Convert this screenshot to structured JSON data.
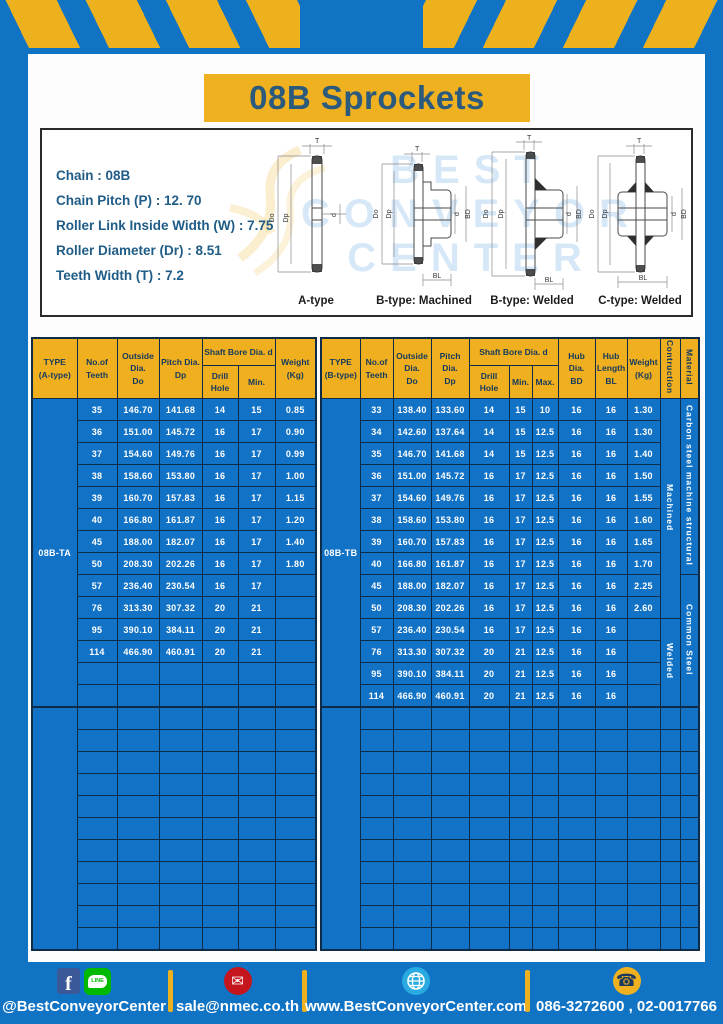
{
  "title": "08B Sprockets",
  "specs": [
    "Chain  : 08B",
    "Chain Pitch (P)  :  12. 70",
    "Roller Link Inside Width (W)  :  7.75",
    "Roller Diameter (Dr)  : 8.51",
    "Teeth Width (T)  :  7.2"
  ],
  "diagrams": {
    "watermark": "BEST CONVEYOR CENTER",
    "captions": [
      "A-type",
      "B-type: Machined",
      "B-type: Welded",
      "C-type: Welded"
    ],
    "dims": {
      "t": "T",
      "outside": "Do",
      "pitch": "Dp",
      "bore": "d",
      "hub_dia": "BD",
      "hub_len": "BL"
    }
  },
  "left_table": {
    "header": {
      "type": "TYPE\n(A-type)",
      "teeth": "No.of\nTeeth",
      "outside": "Outside\nDia.\nDo",
      "pitch": "Pitch Dia.\nDp",
      "shaft_bore": "Shaft Bore Dia. d",
      "drill": "Drill Hole",
      "min": "Min.",
      "weight": "Weight\n(Kg)"
    },
    "type_label": "08B-TA",
    "rows": [
      [
        "35",
        "146.70",
        "141.68",
        "14",
        "15",
        "0.85"
      ],
      [
        "36",
        "151.00",
        "145.72",
        "16",
        "17",
        "0.90"
      ],
      [
        "37",
        "154.60",
        "149.76",
        "16",
        "17",
        "0.99"
      ],
      [
        "38",
        "158.60",
        "153.80",
        "16",
        "17",
        "1.00"
      ],
      [
        "39",
        "160.70",
        "157.83",
        "16",
        "17",
        "1.15"
      ],
      [
        "40",
        "166.80",
        "161.87",
        "16",
        "17",
        "1.20"
      ],
      [
        "45",
        "188.00",
        "182.07",
        "16",
        "17",
        "1.40"
      ],
      [
        "50",
        "208.30",
        "202.26",
        "16",
        "17",
        "1.80"
      ],
      [
        "57",
        "236.40",
        "230.54",
        "16",
        "17",
        ""
      ],
      [
        "76",
        "313.30",
        "307.32",
        "20",
        "21",
        ""
      ],
      [
        "95",
        "390.10",
        "384.11",
        "20",
        "21",
        ""
      ],
      [
        "114",
        "466.90",
        "460.91",
        "20",
        "21",
        ""
      ]
    ],
    "group1_total_rows": 14,
    "group2_empty_rows": 11
  },
  "right_table": {
    "header": {
      "type": "TYPE\n(B-type)",
      "teeth": "No.of\nTeeth",
      "outside": "Outside\nDia.\nDo",
      "pitch": "Pitch Dia.\nDp",
      "shaft_bore": "Shaft Bore Dia. d",
      "drill": "Drill Hole",
      "min": "Min.",
      "max": "Max.",
      "hub_dia": "Hub Dia.\nBD",
      "hub_len": "Hub\nLength\nBL",
      "weight": "Weight\n(Kg)",
      "construction": "Contruction",
      "material": "Material"
    },
    "type_label": "08B-TB",
    "rows": [
      [
        "33",
        "138.40",
        "133.60",
        "14",
        "15",
        "10",
        "16",
        "16",
        "1.30"
      ],
      [
        "34",
        "142.60",
        "137.64",
        "14",
        "15",
        "12.5",
        "16",
        "16",
        "1.30"
      ],
      [
        "35",
        "146.70",
        "141.68",
        "14",
        "15",
        "12.5",
        "16",
        "16",
        "1.40"
      ],
      [
        "36",
        "151.00",
        "145.72",
        "16",
        "17",
        "12.5",
        "16",
        "16",
        "1.50"
      ],
      [
        "37",
        "154.60",
        "149.76",
        "16",
        "17",
        "12.5",
        "16",
        "16",
        "1.55"
      ],
      [
        "38",
        "158.60",
        "153.80",
        "16",
        "17",
        "12.5",
        "16",
        "16",
        "1.60"
      ],
      [
        "39",
        "160.70",
        "157.83",
        "16",
        "17",
        "12.5",
        "16",
        "16",
        "1.65"
      ],
      [
        "40",
        "166.80",
        "161.87",
        "16",
        "17",
        "12.5",
        "16",
        "16",
        "1.70"
      ],
      [
        "45",
        "188.00",
        "182.07",
        "16",
        "17",
        "12.5",
        "16",
        "16",
        "2.25"
      ],
      [
        "50",
        "208.30",
        "202.26",
        "16",
        "17",
        "12.5",
        "16",
        "16",
        "2.60"
      ],
      [
        "57",
        "236.40",
        "230.54",
        "16",
        "17",
        "12.5",
        "16",
        "16",
        ""
      ],
      [
        "76",
        "313.30",
        "307.32",
        "20",
        "21",
        "12.5",
        "16",
        "16",
        ""
      ],
      [
        "95",
        "390.10",
        "384.11",
        "20",
        "21",
        "12.5",
        "16",
        "16",
        ""
      ],
      [
        "114",
        "466.90",
        "460.91",
        "20",
        "21",
        "12.5",
        "16",
        "16",
        ""
      ]
    ],
    "construction_spans": [
      {
        "label": "Machined",
        "rows": 10
      },
      {
        "label": "Welded",
        "rows": 4
      }
    ],
    "material_spans": [
      {
        "label": "Carbon steel  machine structural",
        "rows": 8
      },
      {
        "label": "Common Steel",
        "rows": 6
      }
    ],
    "group2_empty_rows": 11
  },
  "footer": {
    "social_handle": "@BestConveyorCenter",
    "line_badge": "LINE",
    "email": "sale@nmec.co.th",
    "website": "www.BestConveyorCenter.com",
    "phone": "086-3272600 , 02-0017766"
  },
  "colors": {
    "page_blue": "#1173c4",
    "accent_yellow": "#efb120",
    "cell_blue": "#1273c6",
    "grid_dark": "#0e2b48",
    "title_text": "#2b5a7d",
    "spec_text": "#1f5c86"
  }
}
